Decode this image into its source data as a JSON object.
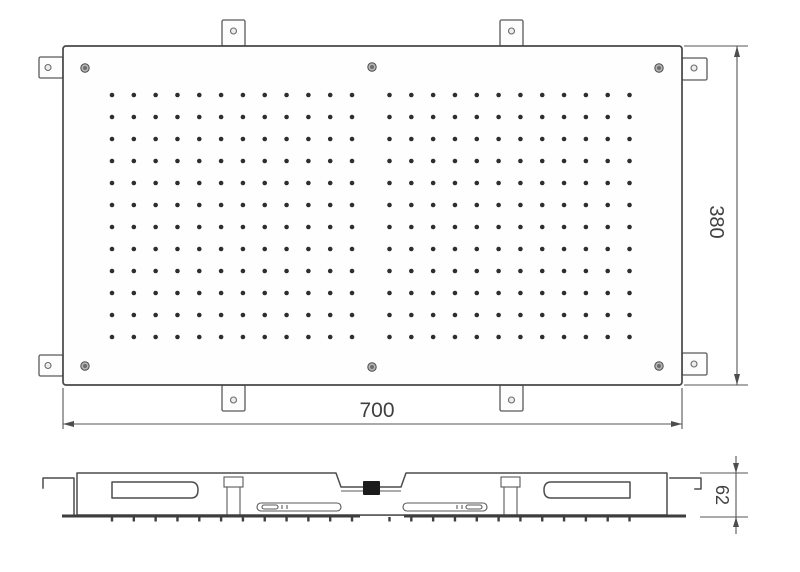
{
  "drawing": {
    "type": "technical-drawing",
    "subject": "ceiling rain shower head panel, dimensioned top and side views",
    "background": "#ffffff",
    "line_color": "#4d4d4d",
    "text_color": "#3f3f3f",
    "dot_color": "#2e2e2e"
  },
  "dimensions": {
    "width": {
      "value": "700"
    },
    "height": {
      "value": "380"
    },
    "depth": {
      "value": "62"
    }
  },
  "hardware": {
    "mounting_tab_count": 8,
    "screw_count": 6,
    "nozzle_dot_count": 288,
    "nozzle_groups": 2
  },
  "nozzle_grid": {
    "rows": 12,
    "cols_per_group": 12,
    "row_start_y": 95,
    "row_step": 22,
    "group_start_x": [
      112,
      389.5
    ],
    "col_step": 21.82,
    "dot_radius": 2.3
  },
  "side_ticks": {
    "y_top": 517,
    "y_bottom": 521.5
  },
  "mounting_tabs": {
    "rects": [
      [
        222,
        20,
        23,
        26
      ],
      [
        500,
        20,
        23,
        26
      ],
      [
        222,
        385,
        23,
        26
      ],
      [
        500,
        385,
        23,
        26
      ],
      [
        39,
        57,
        24,
        21
      ],
      [
        39,
        355,
        24,
        21
      ],
      [
        682,
        58,
        25,
        22
      ],
      [
        682,
        353,
        25,
        22
      ]
    ],
    "holes": [
      [
        233.5,
        31
      ],
      [
        511.5,
        31
      ],
      [
        233.5,
        400
      ],
      [
        511.5,
        400
      ],
      [
        48,
        67.5
      ],
      [
        48,
        365.5
      ],
      [
        694,
        68
      ],
      [
        694,
        364
      ]
    ],
    "hole_radius": 3
  },
  "screws": {
    "positions": [
      [
        85,
        68
      ],
      [
        372,
        67
      ],
      [
        659,
        68
      ],
      [
        85,
        366
      ],
      [
        372,
        367
      ],
      [
        659,
        366
      ]
    ],
    "outer_radius": 4.2,
    "inner_radius": 2
  }
}
